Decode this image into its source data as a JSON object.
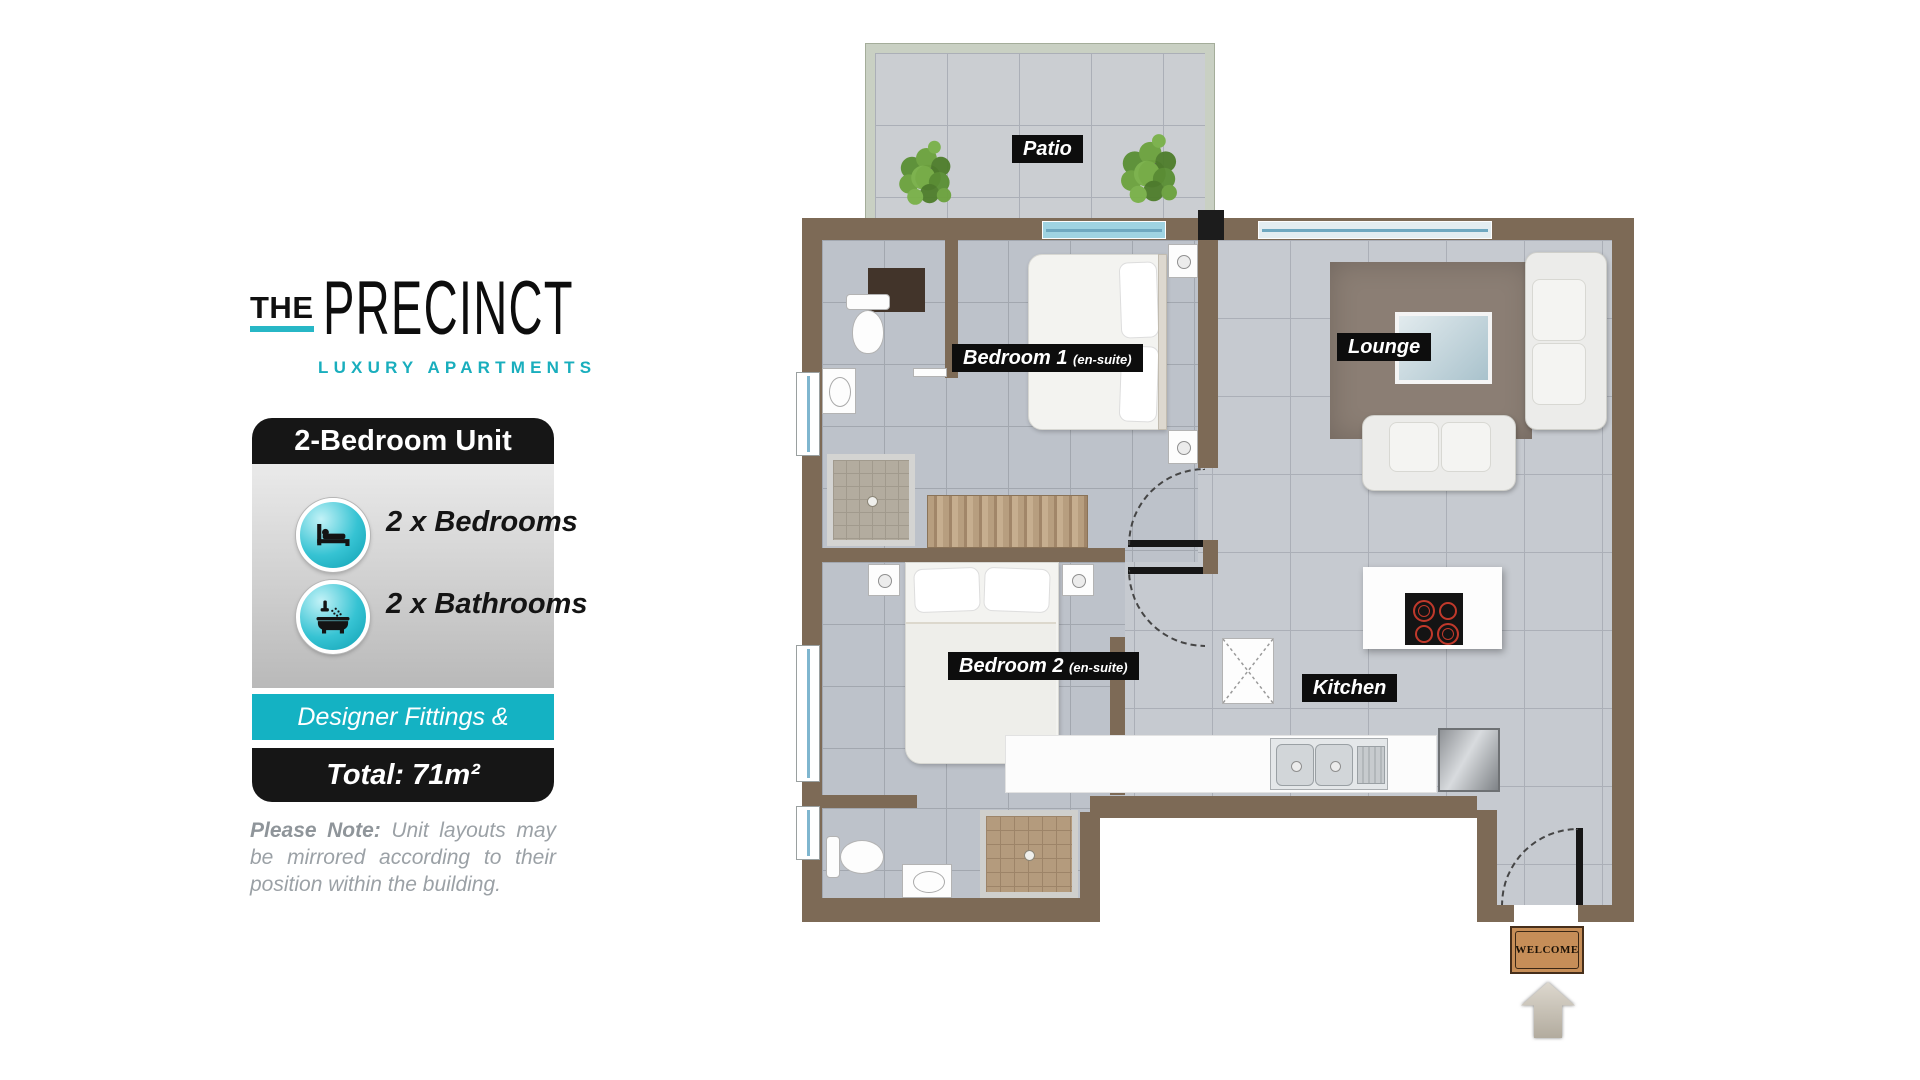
{
  "brand": {
    "word_the": "THE",
    "word_name": "PRECINCT",
    "tagline": "LUXURY APARTMENTS"
  },
  "unit_card": {
    "title": "2-Bedroom Unit",
    "features": [
      {
        "icon": "bed-icon",
        "label": "2 x Bedrooms"
      },
      {
        "icon": "bath-icon",
        "label": "2 x Bathrooms"
      }
    ],
    "banner": "Designer Fittings & Finishes",
    "total_area": "Total: 71m²"
  },
  "note": {
    "lead": "Please Note:",
    "text": " Unit layouts may be mirrored according to their position within the building."
  },
  "floorplan": {
    "labels": {
      "patio": "Patio",
      "bedroom1": "Bedroom 1",
      "bedroom1_suffix": "(en-suite)",
      "bedroom2": "Bedroom 2",
      "bedroom2_suffix": "(en-suite)",
      "lounge": "Lounge",
      "kitchen": "Kitchen"
    },
    "welcome_mat": "WELCOME"
  },
  "colors": {
    "teal": "#19aebd",
    "wall_brown": "#7d6a56",
    "label_bg": "#0d0d0d"
  }
}
